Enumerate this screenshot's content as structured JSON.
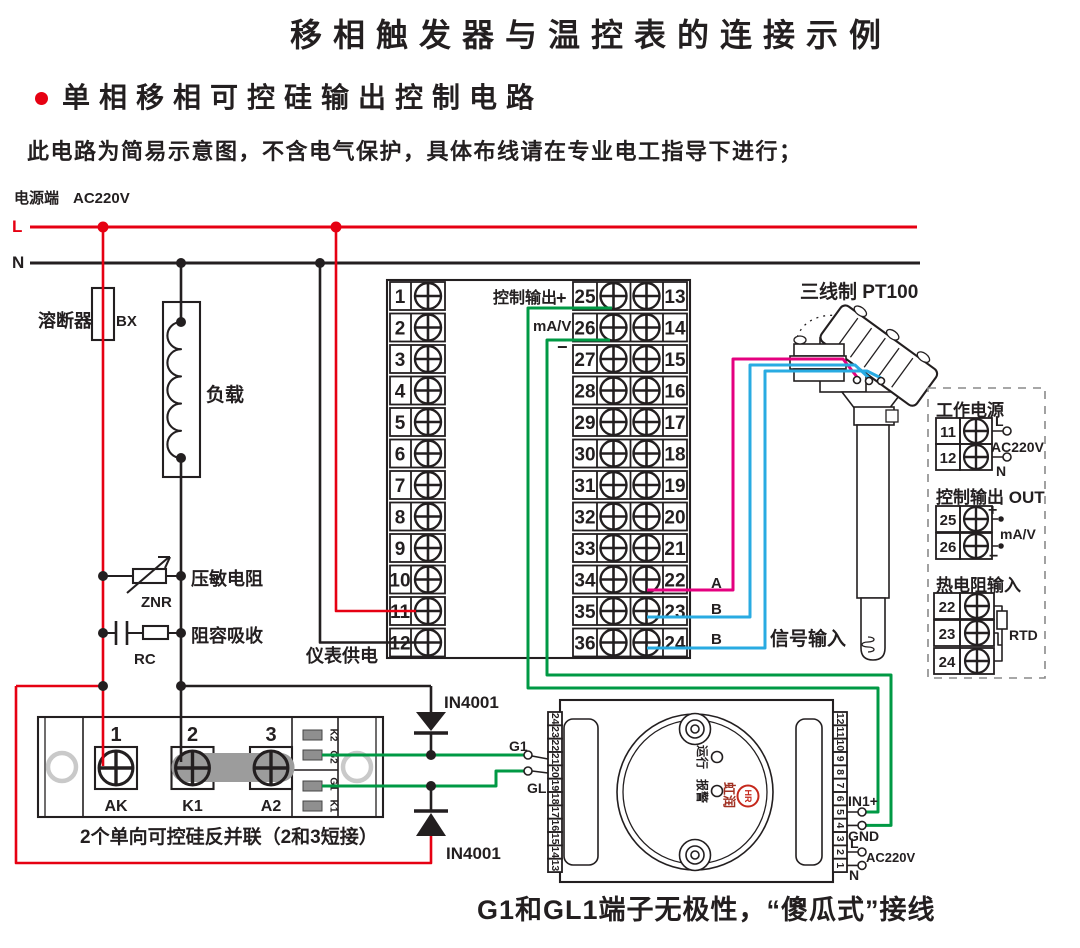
{
  "page": {
    "title": "移相触发器与温控表的连接示例",
    "subtitle": "单相移相可控硅输出控制电路",
    "note": "此电路为简易示意图，不含电气保护，具体布线请在专业电工指导下进行；",
    "bottom_note": "G1和GL1端子无极性，“傻瓜式”接线"
  },
  "power": {
    "label": "电源端",
    "voltage": "AC220V",
    "live": "L",
    "neutral": "N"
  },
  "left_branch": {
    "fuse": "溶断器",
    "fuse_code": "BX",
    "load": "负载",
    "varistor": "压敏电阻",
    "varistor_code": "ZNR",
    "rc": "阻容吸收",
    "rc_code": "RC",
    "meter_supply": "仪表供电"
  },
  "main_block": {
    "left_terminals": [
      "1",
      "2",
      "3",
      "4",
      "5",
      "6",
      "7",
      "8",
      "9",
      "10",
      "11",
      "12"
    ],
    "mid_terminals": [
      "25",
      "26",
      "27",
      "28",
      "29",
      "30",
      "31",
      "32",
      "33",
      "34",
      "35",
      "36"
    ],
    "right_terminals": [
      "13",
      "14",
      "15",
      "16",
      "17",
      "18",
      "19",
      "20",
      "21",
      "22",
      "23",
      "24"
    ],
    "output": "控制输出",
    "plus": "+",
    "unit": "mA/V",
    "minus": "−",
    "wire_a": "A",
    "wire_b1": "B",
    "wire_b2": "B",
    "signal_input": "信号输入"
  },
  "diodes": {
    "top": "IN4001",
    "bottom": "IN4001"
  },
  "scr": {
    "t1": "1",
    "t2": "2",
    "t3": "3",
    "n1": "AK",
    "n2": "K1",
    "n3": "A2",
    "pads": [
      "K2",
      "G2",
      "G1",
      "K1"
    ],
    "caption": "2个单向可控硅反并联（2和3短接）"
  },
  "trigger": {
    "left_terminals": [
      "24",
      "23",
      "22",
      "21",
      "20",
      "19",
      "18",
      "17",
      "16",
      "15",
      "14",
      "13"
    ],
    "right_terminals": [
      "12",
      "11",
      "10",
      "9",
      "8",
      "7",
      "6",
      "5",
      "4",
      "3",
      "2",
      "1"
    ],
    "g1": "G1",
    "gl1": "GL1",
    "in1": "IN1+",
    "gnd": "GND",
    "l": "L",
    "ac": "AC220V",
    "n": "N",
    "run": "运行",
    "alarm": "报警",
    "brand": "虹润",
    "logo": "HR"
  },
  "sensor": {
    "label": "三线制 PT100"
  },
  "panel": {
    "power_title": "工作电源",
    "p_t1": "11",
    "p_t2": "12",
    "p_l": "L",
    "p_ac": "AC220V",
    "p_n": "N",
    "out_title": "控制输出 OUT",
    "o_t1": "25",
    "o_t2": "26",
    "o_plus": "+",
    "o_unit": "mA/V",
    "o_minus": "−",
    "rtd_title": "热电阻输入",
    "r_t1": "22",
    "r_t2": "23",
    "r_t3": "24",
    "rtd": "RTD"
  },
  "colors": {
    "live": "#e60012",
    "neutral": "#231f20",
    "control_wire": "#009944",
    "signal_a": "#e4007f",
    "signal_b": "#29abe2"
  }
}
